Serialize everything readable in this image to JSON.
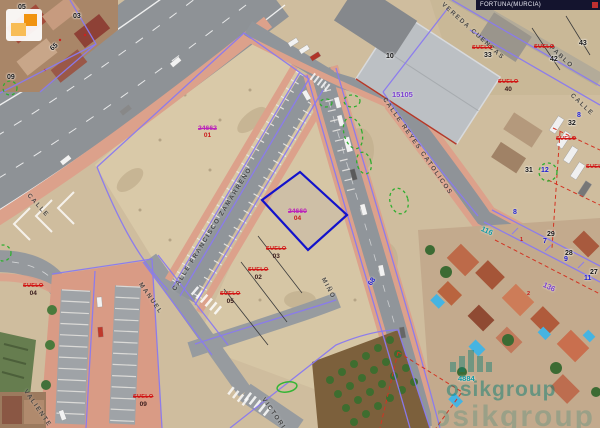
{
  "header": {
    "title": "FORTUNA(MURCIA)"
  },
  "watermark": {
    "brand": "osikgroup",
    "brand_color": "#0f7f74"
  },
  "palette": {
    "boundary_purple": "#8a7af0",
    "selected_parcel_blue": "#1212cc",
    "suelo_red": "#d11414",
    "ref_magenta": "#bb22bb",
    "axis_blue": "#1d1dd2",
    "street_ref_teal": "#0d9aa5",
    "map_ref_violet": "#7a3fd1",
    "vegetation_green": "#2fae2f",
    "sidewalk_pink": "#dca18b",
    "asphalt_gray": "#8f9398",
    "dirt_tan": "#d6c6a5"
  },
  "map": {
    "suelo_word": "SUELO",
    "labels": [
      {
        "kind": "street",
        "text": "CALLE",
        "x": 30,
        "y": 193,
        "rot": 48
      },
      {
        "kind": "street",
        "text": "CALLE FRANCISCO ZAMARREÑO",
        "x": 172,
        "y": 289,
        "rot": -58
      },
      {
        "kind": "street",
        "text": "MANUEL",
        "x": 142,
        "y": 282,
        "rot": 55
      },
      {
        "kind": "street",
        "text": "MIÑO",
        "x": 325,
        "y": 277,
        "rot": 62
      },
      {
        "kind": "street",
        "text": "VALIENTE",
        "x": 27,
        "y": 389,
        "rot": 55
      },
      {
        "kind": "street",
        "text": "VICTORIA",
        "x": 265,
        "y": 397,
        "rot": 55
      },
      {
        "kind": "street",
        "text": "CALLE REYES CATOLICOS",
        "x": 386,
        "y": 97,
        "rot": 55
      },
      {
        "kind": "street",
        "text": "VEREDA CUENCAS",
        "x": 444,
        "y": 2,
        "rot": 42
      },
      {
        "kind": "street",
        "text": "CALLE",
        "x": 573,
        "y": 93,
        "rot": 43
      },
      {
        "kind": "street",
        "text": "PABLO",
        "x": 552,
        "y": 45,
        "rot": 43
      },
      {
        "kind": "nb",
        "text": "05",
        "x": 18,
        "y": 4
      },
      {
        "kind": "nb",
        "text": "03",
        "x": 73,
        "y": 13
      },
      {
        "kind": "nb",
        "text": "65",
        "x": 49,
        "y": 47,
        "rot": -40
      },
      {
        "kind": "nb",
        "text": "09",
        "x": 7,
        "y": 74
      },
      {
        "kind": "nb",
        "text": "10",
        "x": 386,
        "y": 53
      },
      {
        "kind": "nb",
        "text": "33",
        "x": 484,
        "y": 52
      },
      {
        "kind": "nb",
        "text": "43",
        "x": 579,
        "y": 40
      },
      {
        "kind": "nb",
        "text": "42",
        "x": 550,
        "y": 56
      },
      {
        "kind": "nb",
        "text": "32",
        "x": 568,
        "y": 120
      },
      {
        "kind": "nb",
        "text": "31",
        "x": 525,
        "y": 167
      },
      {
        "kind": "nb",
        "text": "29",
        "x": 547,
        "y": 231
      },
      {
        "kind": "nb",
        "text": "28",
        "x": 565,
        "y": 250
      },
      {
        "kind": "nb",
        "text": "27",
        "x": 590,
        "y": 269
      },
      {
        "kind": "nblue",
        "text": "8",
        "x": 513,
        "y": 209
      },
      {
        "kind": "nblue",
        "text": "7",
        "x": 543,
        "y": 238
      },
      {
        "kind": "nblue",
        "text": "9",
        "x": 564,
        "y": 256
      },
      {
        "kind": "nblue",
        "text": "11",
        "x": 584,
        "y": 275
      },
      {
        "kind": "nblue",
        "text": "12",
        "x": 541,
        "y": 167
      },
      {
        "kind": "nblue",
        "text": "8",
        "x": 577,
        "y": 112
      },
      {
        "kind": "nblue",
        "text": "68",
        "x": 367,
        "y": 283,
        "rot": -55
      },
      {
        "kind": "violet",
        "text": "15105",
        "x": 392,
        "y": 91
      },
      {
        "kind": "teal",
        "text": "116",
        "x": 483,
        "y": 225,
        "rot": 25
      },
      {
        "kind": "violet",
        "text": "136",
        "x": 545,
        "y": 281,
        "rot": 25
      },
      {
        "kind": "teal",
        "text": "4884",
        "x": 458,
        "y": 375
      },
      {
        "kind": "ref",
        "text": "24662",
        "num": "01",
        "x": 198,
        "y": 126
      },
      {
        "kind": "ref",
        "text": "24660",
        "num": "04",
        "x": 288,
        "y": 209
      },
      {
        "kind": "suelo",
        "num": "03",
        "x": 266,
        "y": 247
      },
      {
        "kind": "suelo",
        "num": "02",
        "x": 248,
        "y": 268
      },
      {
        "kind": "suelo",
        "num": "05",
        "x": 220,
        "y": 292
      },
      {
        "kind": "suelo",
        "num": "04",
        "x": 23,
        "y": 284
      },
      {
        "kind": "suelo",
        "num": "09",
        "x": 133,
        "y": 395
      },
      {
        "kind": "suelo",
        "num": "40",
        "x": 498,
        "y": 80
      },
      {
        "kind": "suelo",
        "x": 534,
        "y": 45
      },
      {
        "kind": "suelo",
        "x": 472,
        "y": 46
      },
      {
        "kind": "suelo",
        "x": 556,
        "y": 137
      },
      {
        "kind": "suelo",
        "x": 586,
        "y": 165
      },
      {
        "kind": "nred",
        "text": "1",
        "x": 520,
        "y": 238
      },
      {
        "kind": "nred",
        "text": "2",
        "x": 527,
        "y": 292
      }
    ]
  }
}
